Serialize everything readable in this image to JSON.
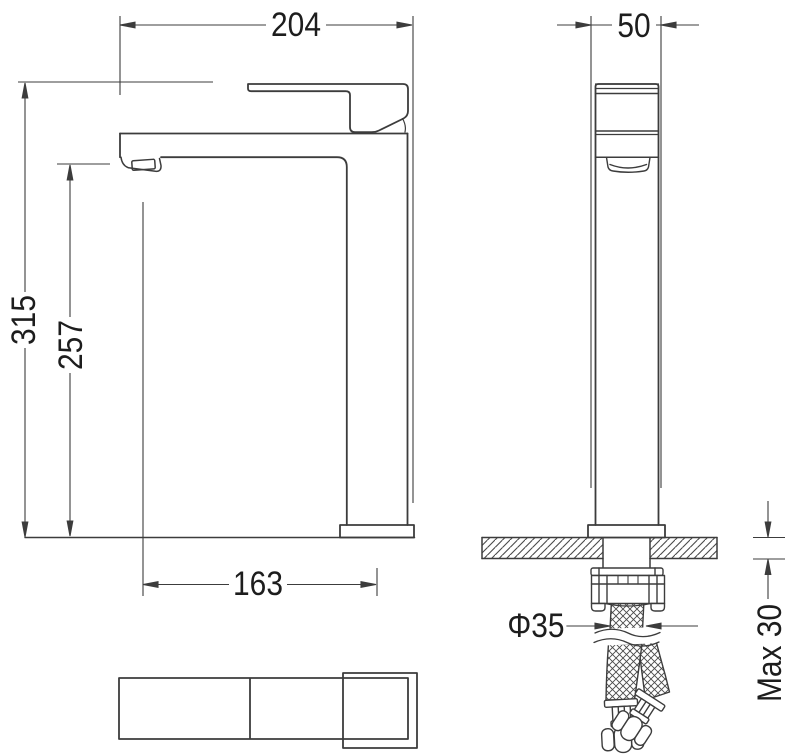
{
  "drawing": {
    "kind": "technical dimension drawing",
    "views": [
      "front",
      "side",
      "top"
    ]
  },
  "dimensions": {
    "overall_width": "204",
    "body_depth": "50",
    "overall_height": "315",
    "spout_height": "257",
    "spout_reach": "163",
    "hole_diameter": "Φ35",
    "max_mounting_thickness": "Max 30"
  },
  "colors": {
    "object_line": "#3c3c3c",
    "dimension_line": "#3c3c3c",
    "text": "#1d1d1d",
    "background": "#ffffff"
  }
}
